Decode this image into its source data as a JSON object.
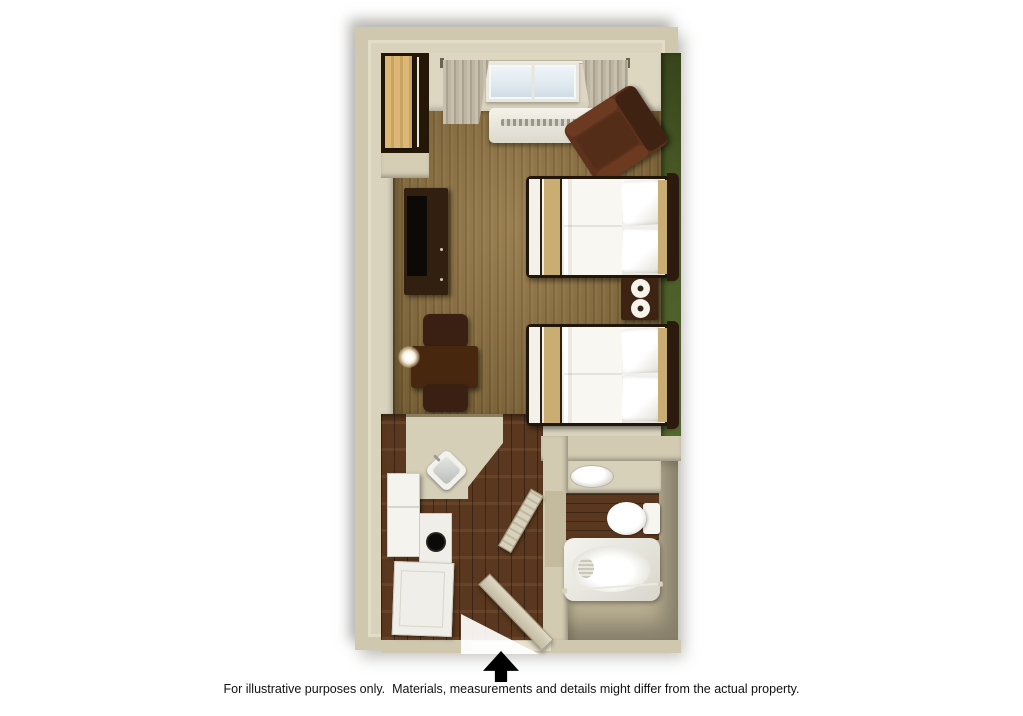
{
  "caption": {
    "text": "For illustrative purposes only.  Materials, measurements and details might differ from the actual property."
  },
  "entrance": {
    "icon": "entrance-arrow-up"
  },
  "colors": {
    "wallOuter": "#cfc8ae",
    "wallFace": "#d9d3bd",
    "accentGreen": "#4a5a26",
    "carpet": "#8f713d",
    "wood": "#5a381f",
    "bathFloor": "#b9af92",
    "counter": "#d6cfb8",
    "runnerGold": "#c9ad72",
    "closetWood": "#dcb775",
    "chairBrown": "#5c321c",
    "linenWhite": "#f8f7f2"
  }
}
